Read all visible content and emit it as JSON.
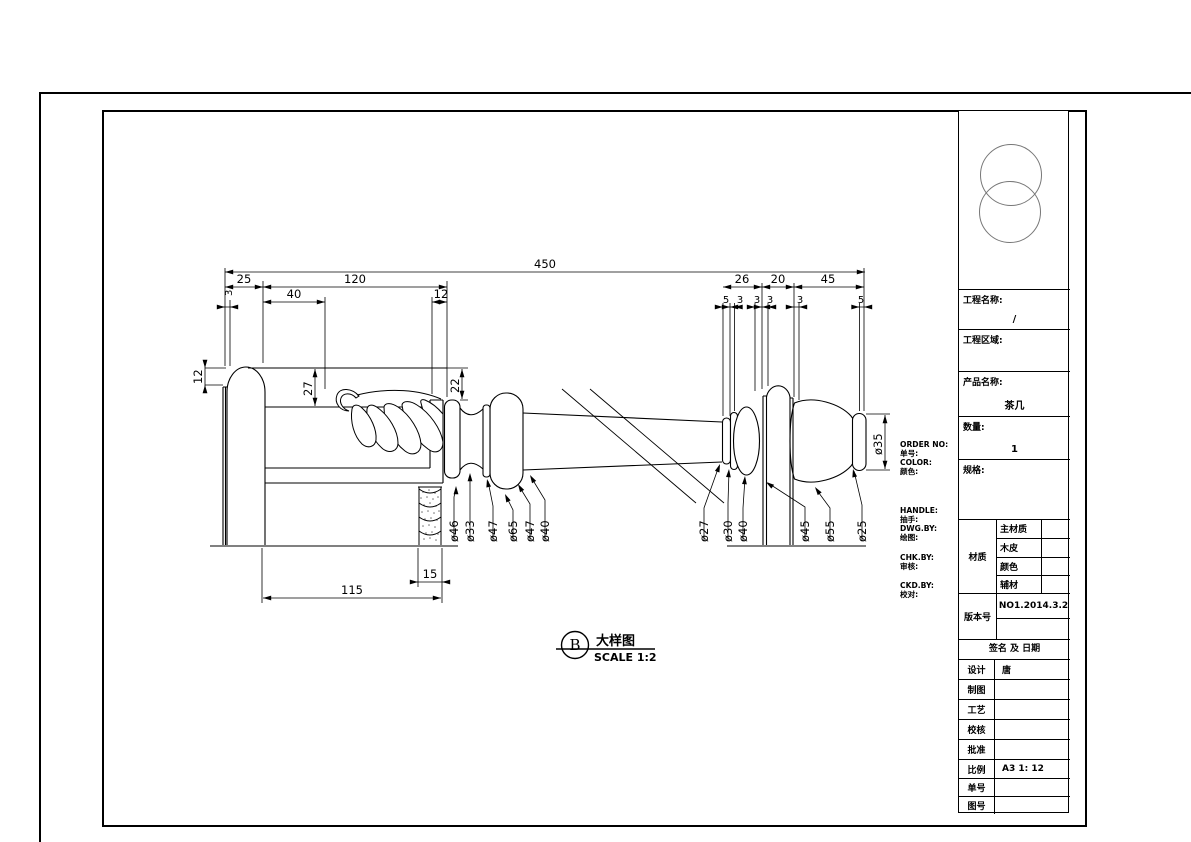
{
  "drawing": {
    "detail": {
      "letter": "B",
      "title": "大样图",
      "scale": "SCALE 1:2"
    },
    "dims": {
      "overall": "450",
      "a25": "25",
      "a120": "120",
      "a40": "40",
      "a12": "12",
      "b26": "26",
      "b20": "20",
      "b45": "45",
      "s5a": "5",
      "s3a": "3",
      "s3b": "3",
      "s3c": "3",
      "s3d": "3",
      "s5b": "5",
      "l3": "3",
      "l12": "12",
      "l27": "27",
      "l22": "22",
      "g115": "115",
      "g15": "15",
      "dia35": "ø35"
    },
    "dia_left": [
      "ø46",
      "ø33",
      "ø47",
      "ø65",
      "ø47",
      "ø40"
    ],
    "dia_right": [
      "ø27",
      "ø30",
      "ø40",
      "ø45",
      "ø55",
      "ø25"
    ],
    "notes": [
      "ORDER NO:",
      "单号:",
      "COLOR:",
      "颜色:",
      "HANDLE:",
      "抽手:",
      "DWG.BY:",
      "绘图:",
      "CHK.BY:",
      "审核:",
      "CKD.BY:",
      "校对:"
    ]
  },
  "title_block": {
    "project_name_label": "工程名称:",
    "project_name_value": "/",
    "project_area_label": "工程区域:",
    "product_name_label": "产品名称:",
    "product_name_value": "茶几",
    "quantity_label": "数量:",
    "quantity_value": "1",
    "spec_label": "规格:",
    "material_label": "材质",
    "material_rows": [
      {
        "label": "主材质",
        "value": ""
      },
      {
        "label": "木皮",
        "value": ""
      },
      {
        "label": "颜色",
        "value": ""
      },
      {
        "label": "辅材",
        "value": ""
      }
    ],
    "version_label": "版本号",
    "version_value": "NO1.2014.3.2",
    "sign_header": "签名 及 日期",
    "sign_rows": [
      {
        "label": "设计",
        "value": "唐"
      },
      {
        "label": "制图",
        "value": ""
      },
      {
        "label": "工艺",
        "value": ""
      },
      {
        "label": "校核",
        "value": ""
      },
      {
        "label": "批准",
        "value": ""
      },
      {
        "label": "比例",
        "value": "A3 1: 12"
      },
      {
        "label": "单号",
        "value": ""
      },
      {
        "label": "图号",
        "value": ""
      }
    ]
  }
}
